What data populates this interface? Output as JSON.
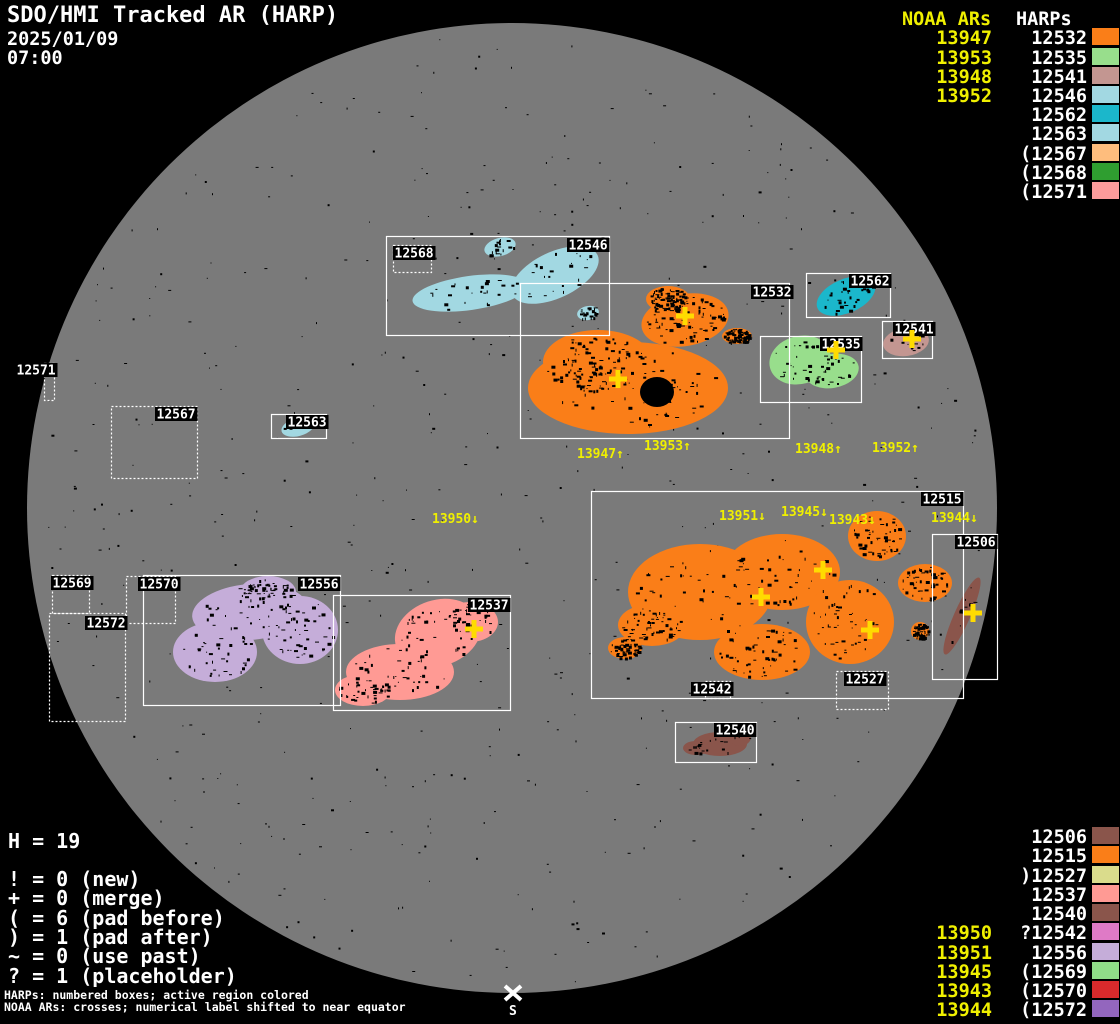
{
  "title": {
    "app": "SDO/HMI Tracked AR (HARP)",
    "date": "2025/01/09",
    "time": "07:00"
  },
  "colors": {
    "background": "#000000",
    "disk": "#7A7A7A",
    "box_line": "#FFFFFF",
    "harp_label_text": "#FFFFFF",
    "harp_label_bg": "#000000",
    "noaa_text": "#F0F000",
    "cross": "#FFDB00",
    "speckle": "#000000",
    "south_marker": "#FFFFFF"
  },
  "legend_top_right": {
    "noaa_header": "NOAA ARs",
    "harp_header": "HARPs",
    "rows": [
      {
        "noaa": "13947",
        "harp": "12532",
        "color": "#FA7E18"
      },
      {
        "noaa": "13953",
        "harp": "12535",
        "color": "#98DE8C"
      },
      {
        "noaa": "13948",
        "harp": "12541",
        "color": "#C39691"
      },
      {
        "noaa": "13952",
        "harp": "12546",
        "color": "#A2D8E2"
      },
      {
        "noaa": "",
        "harp": "12562",
        "color": "#1BB7CB"
      },
      {
        "noaa": "",
        "harp": "12563",
        "color": "#A2D8E2"
      },
      {
        "noaa": "",
        "harp": "(12567",
        "color": "#FEBD7D"
      },
      {
        "noaa": "",
        "harp": "(12568",
        "color": "#2F9E30"
      },
      {
        "noaa": "",
        "harp": "(12571",
        "color": "#FC9B9B"
      }
    ]
  },
  "legend_bottom_right": {
    "rows": [
      {
        "noaa": "",
        "harp": "12506",
        "color": "#8A554B"
      },
      {
        "noaa": "",
        "harp": "12515",
        "color": "#FA7E18"
      },
      {
        "noaa": "",
        "harp": ")12527",
        "color": "#DADC8C"
      },
      {
        "noaa": "",
        "harp": "12537",
        "color": "#FF9A94"
      },
      {
        "noaa": "",
        "harp": "12540",
        "color": "#8A554B"
      },
      {
        "noaa": "13950",
        "harp": "?12542",
        "color": "#DF7AC6"
      },
      {
        "noaa": "13951",
        "harp": "12556",
        "color": "#C5ADD9"
      },
      {
        "noaa": "13945",
        "harp": "(12569",
        "color": "#90DD88"
      },
      {
        "noaa": "13943",
        "harp": "(12570",
        "color": "#D92A2C"
      },
      {
        "noaa": "13944",
        "harp": "(12572",
        "color": "#9366BE"
      }
    ]
  },
  "stats": {
    "harp_count": "H = 19",
    "flags": [
      "! = 0 (new)",
      "+ = 0 (merge)",
      "( = 6 (pad before)",
      ") = 1 (pad after)",
      "~ = 0 (use past)",
      "? = 1 (placeholder)"
    ]
  },
  "footnotes": [
    "HARPs: numbered boxes; active region colored",
    "NOAA ARs: crosses; numerical label shifted to near equator"
  ],
  "south_marker": {
    "label": "S",
    "x": 513,
    "y": 993
  },
  "sun": {
    "cx": 512,
    "cy": 508,
    "r": 485
  },
  "harp_boxes": [
    {
      "id": "12546",
      "x": 386,
      "y": 236,
      "w": 223,
      "h": 99,
      "style": "solid",
      "lx": 567,
      "ly": 238
    },
    {
      "id": "12568",
      "x": 393,
      "y": 245,
      "w": 38,
      "h": 27,
      "style": "dotted",
      "lx": 393,
      "ly": 246
    },
    {
      "id": "12532",
      "x": 520,
      "y": 283,
      "w": 269,
      "h": 155,
      "style": "solid",
      "lx": 751,
      "ly": 285
    },
    {
      "id": "12562",
      "x": 806,
      "y": 273,
      "w": 84,
      "h": 44,
      "style": "solid",
      "lx": 849,
      "ly": 274
    },
    {
      "id": "12541",
      "x": 882,
      "y": 321,
      "w": 50,
      "h": 37,
      "style": "solid",
      "lx": 893,
      "ly": 322
    },
    {
      "id": "12535",
      "x": 760,
      "y": 336,
      "w": 101,
      "h": 66,
      "style": "solid",
      "lx": 820,
      "ly": 337
    },
    {
      "id": "12563",
      "x": 271,
      "y": 414,
      "w": 55,
      "h": 24,
      "style": "solid",
      "lx": 286,
      "ly": 415
    },
    {
      "id": "12571",
      "x": 44,
      "y": 363,
      "w": 10,
      "h": 37,
      "style": "dotted",
      "lx": 15,
      "ly": 363
    },
    {
      "id": "12567",
      "x": 111,
      "y": 406,
      "w": 86,
      "h": 72,
      "style": "dotted",
      "lx": 155,
      "ly": 407
    },
    {
      "id": "12569",
      "x": 52,
      "y": 575,
      "w": 37,
      "h": 38,
      "style": "dotted",
      "lx": 51,
      "ly": 576
    },
    {
      "id": "12572",
      "x": 49,
      "y": 613,
      "w": 76,
      "h": 108,
      "style": "dotted",
      "lx": 85,
      "ly": 616
    },
    {
      "id": "12570",
      "x": 126,
      "y": 576,
      "w": 49,
      "h": 47,
      "style": "dotted",
      "lx": 138,
      "ly": 577
    },
    {
      "id": "12556",
      "x": 143,
      "y": 575,
      "w": 197,
      "h": 130,
      "style": "solid",
      "lx": 298,
      "ly": 577
    },
    {
      "id": "12537",
      "x": 333,
      "y": 595,
      "w": 177,
      "h": 115,
      "style": "solid",
      "lx": 468,
      "ly": 598
    },
    {
      "id": "12515",
      "x": 591,
      "y": 491,
      "w": 372,
      "h": 207,
      "style": "solid",
      "lx": 921,
      "ly": 492
    },
    {
      "id": "12506",
      "x": 932,
      "y": 534,
      "w": 65,
      "h": 145,
      "style": "solid",
      "lx": 955,
      "ly": 535
    },
    {
      "id": "12527",
      "x": 836,
      "y": 671,
      "w": 52,
      "h": 38,
      "style": "dotted",
      "lx": 844,
      "ly": 672
    },
    {
      "id": "12542",
      "x": 705,
      "y": 681,
      "w": 25,
      "h": 17,
      "style": "dotted",
      "lx": 691,
      "ly": 682
    },
    {
      "id": "12540",
      "x": 675,
      "y": 722,
      "w": 81,
      "h": 40,
      "style": "solid",
      "lx": 714,
      "ly": 723
    }
  ],
  "noaa_crosses": [
    {
      "x": 685,
      "y": 316
    },
    {
      "x": 618,
      "y": 379
    },
    {
      "x": 836,
      "y": 350
    },
    {
      "x": 912,
      "y": 339
    },
    {
      "x": 474,
      "y": 629
    },
    {
      "x": 823,
      "y": 570
    },
    {
      "x": 761,
      "y": 597
    },
    {
      "x": 870,
      "y": 630
    },
    {
      "x": 973,
      "y": 613
    }
  ],
  "noaa_shifted_labels": [
    {
      "text": "13947↑",
      "x": 577,
      "y": 447
    },
    {
      "text": "13953↑",
      "x": 644,
      "y": 439
    },
    {
      "text": "13948↑",
      "x": 795,
      "y": 442
    },
    {
      "text": "13952↑",
      "x": 872,
      "y": 441
    },
    {
      "text": "13950↓",
      "x": 432,
      "y": 512
    },
    {
      "text": "13951↓",
      "x": 719,
      "y": 509
    },
    {
      "text": "13945↓",
      "x": 781,
      "y": 505
    },
    {
      "text": "13943↓",
      "x": 829,
      "y": 513
    },
    {
      "text": "13944↓",
      "x": 931,
      "y": 511
    }
  ],
  "regions": [
    {
      "harp": "12546",
      "speckles": 90,
      "ellipses": [
        [
          470,
          293,
          58,
          17,
          -8
        ],
        [
          555,
          275,
          47,
          23,
          -25
        ],
        [
          500,
          247,
          16,
          9,
          -15
        ],
        [
          588,
          313,
          11,
          7,
          -10
        ]
      ]
    },
    {
      "harp": "12532",
      "speckles": 420,
      "ellipses": [
        [
          628,
          388,
          100,
          46,
          0
        ],
        [
          685,
          320,
          44,
          26,
          -10
        ],
        [
          598,
          362,
          55,
          32,
          0
        ],
        [
          737,
          336,
          15,
          8,
          0
        ],
        [
          668,
          299,
          22,
          13,
          0
        ]
      ]
    },
    {
      "harp": "12562",
      "speckles": 30,
      "ellipses": [
        [
          846,
          296,
          31,
          17,
          -23
        ]
      ]
    },
    {
      "harp": "12535",
      "speckles": 50,
      "ellipses": [
        [
          800,
          360,
          31,
          24,
          -15
        ],
        [
          832,
          371,
          27,
          17,
          -10
        ]
      ]
    },
    {
      "harp": "12541",
      "speckles": 14,
      "ellipses": [
        [
          906,
          342,
          23,
          14,
          -8
        ]
      ]
    },
    {
      "harp": "12563",
      "speckles": 6,
      "ellipses": [
        [
          298,
          427,
          17,
          9,
          -15
        ]
      ]
    },
    {
      "harp": "12556",
      "speckles": 170,
      "ellipses": [
        [
          250,
          612,
          58,
          28,
          -5
        ],
        [
          215,
          652,
          42,
          30,
          0
        ],
        [
          300,
          630,
          38,
          34,
          0
        ],
        [
          268,
          592,
          28,
          16,
          0
        ]
      ]
    },
    {
      "harp": "12537",
      "speckles": 150,
      "ellipses": [
        [
          438,
          633,
          44,
          33,
          -18
        ],
        [
          400,
          672,
          54,
          28,
          0
        ],
        [
          363,
          690,
          28,
          16,
          0
        ],
        [
          470,
          622,
          28,
          20,
          0
        ]
      ]
    },
    {
      "harp": "12515",
      "speckles": 470,
      "ellipses": [
        [
          700,
          592,
          72,
          48,
          0
        ],
        [
          782,
          572,
          58,
          38,
          0
        ],
        [
          850,
          622,
          44,
          42,
          0
        ],
        [
          762,
          652,
          48,
          28,
          0
        ],
        [
          877,
          536,
          29,
          25,
          0
        ],
        [
          925,
          583,
          27,
          19,
          0
        ],
        [
          920,
          631,
          9,
          9,
          0
        ],
        [
          652,
          625,
          34,
          21,
          0
        ],
        [
          625,
          648,
          17,
          11,
          0
        ]
      ]
    },
    {
      "harp": "12506",
      "speckles": 12,
      "ellipses": [
        [
          962,
          616,
          42,
          8,
          -66
        ]
      ]
    },
    {
      "harp": "12540",
      "speckles": 28,
      "ellipses": [
        [
          720,
          744,
          27,
          12,
          0
        ],
        [
          696,
          748,
          13,
          7,
          0
        ],
        [
          740,
          737,
          11,
          9,
          0
        ]
      ]
    }
  ],
  "sunspot": {
    "cx": 657,
    "cy": 392,
    "rx": 17,
    "ry": 15
  },
  "disk_speckle_count": 560
}
